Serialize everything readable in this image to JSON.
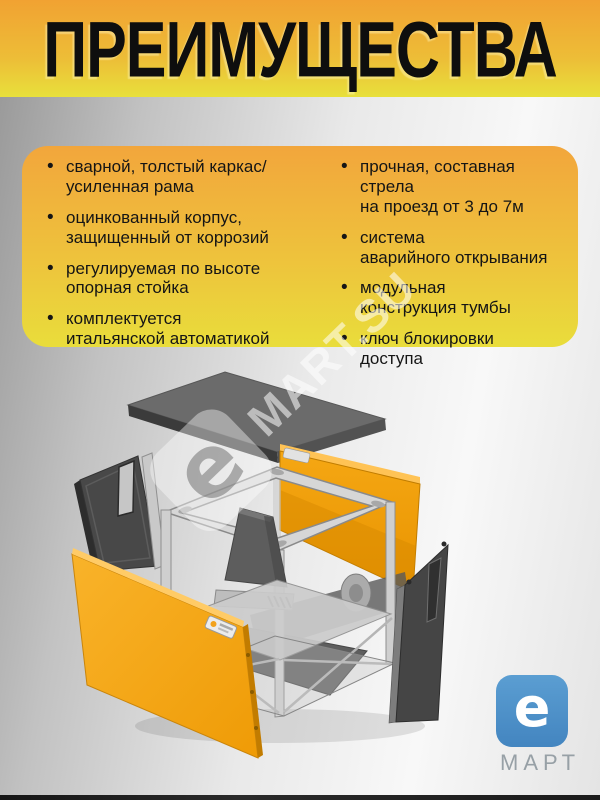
{
  "header": {
    "title": "ПРЕИМУЩЕСТВА"
  },
  "advantages": {
    "left": [
      "сварной, толстый каркас/\nусиленная рама",
      "оцинкованный корпус,\nзащищенный от коррозий",
      "регулируемая по высоте\nопорная стойка",
      "комплектуется\nитальянской автоматикой"
    ],
    "right": [
      "прочная, составная стрела\nна проезд от 3 до 7м",
      "система\nаварийного открывания",
      "модульная\nконструкция тумбы",
      "ключ блокировки\nдоступа"
    ]
  },
  "watermark": {
    "letter": "e",
    "text": "MART.SU"
  },
  "logo": {
    "letter": "e",
    "name": "МАРТ"
  },
  "diagram": {
    "label": "exploded view of automatic barrier cabinet"
  },
  "colors": {
    "header_orange": "#f1a232",
    "header_yellow": "#e8e03b",
    "card_orange": "#f2a63c",
    "card_yellow": "#e9dd3b",
    "panel_orange": "#f29d08",
    "front_panel_orange": "#f6a71b",
    "metal_gray": "#d6d6d6",
    "dark_panel_gray": "#484848",
    "logo_blue": "#4a8fc9",
    "logo_text_gray": "#97a0a6",
    "text_black": "#151515"
  }
}
